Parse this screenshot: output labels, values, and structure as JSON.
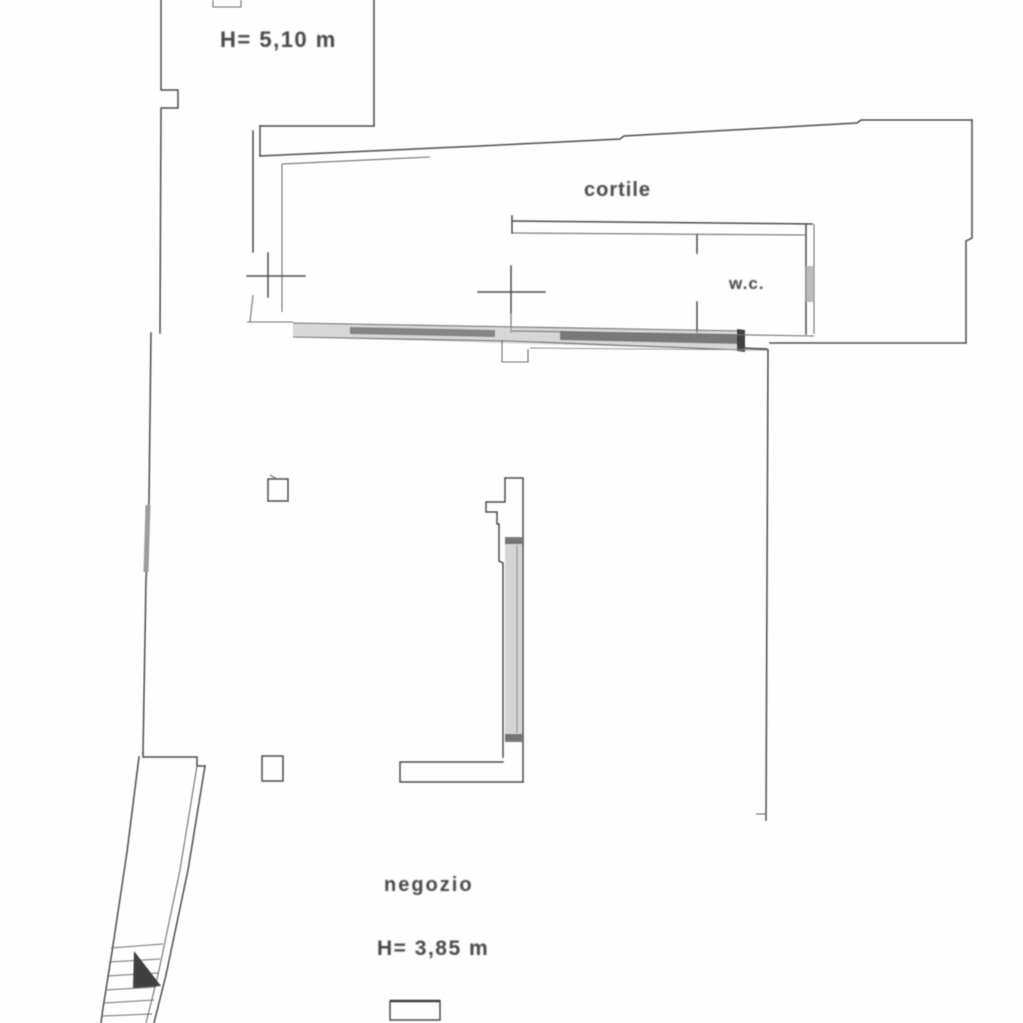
{
  "floorplan": {
    "labels": {
      "upper_height": "H= 5,10 m",
      "cortile": "cortile",
      "wc": "w.c.",
      "negozio": "negozio",
      "negozio_height": "H= 3,85 m"
    },
    "colors": {
      "ink": "#4a4a4a",
      "shade": "#b0b0b0",
      "background": "#ffffff"
    }
  }
}
